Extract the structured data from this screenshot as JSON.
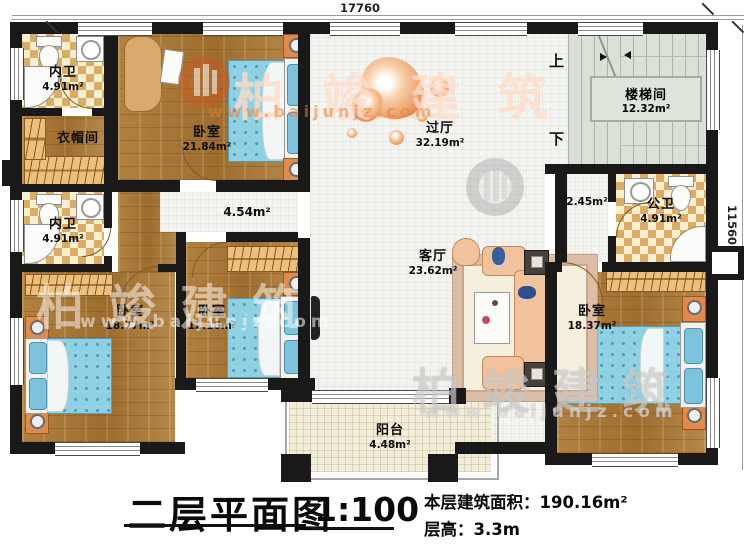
{
  "title_block": {
    "title": "二层平面图",
    "scale": "1:100",
    "building_area": "本层建筑面积：190.16m²",
    "floor_height": "层高：3.3m"
  },
  "dimensions": {
    "top": "17760",
    "right": "11560"
  },
  "stairs": {
    "name": "楼梯间",
    "area": "12.32m²",
    "up": "上",
    "down": "下"
  },
  "rooms": {
    "bath_top_left": {
      "name": "内卫",
      "area": "4.91m²"
    },
    "cloakroom": {
      "name": "衣帽间"
    },
    "bedroom_top": {
      "name": "卧室",
      "area": "21.84m²"
    },
    "bath_mid_left": {
      "name": "内卫",
      "area": "4.91m²"
    },
    "corridor": {
      "area": "4.54m²"
    },
    "hall": {
      "name": "过厅",
      "area": "32.19m²"
    },
    "corridor_small": {
      "area": "2.45m²"
    },
    "bath_public": {
      "name": "公卫",
      "area": "4.91m²"
    },
    "living": {
      "name": "客厅",
      "area": "23.62m²"
    },
    "bedroom_left": {
      "name": "卧室",
      "area": "18.77m²"
    },
    "bedroom_mid": {
      "name": "卧室",
      "area": "12.16m²"
    },
    "bedroom_right": {
      "name": "卧室",
      "area": "18.37m²"
    },
    "balcony": {
      "name": "阳台",
      "area": "4.48m²"
    }
  },
  "watermark": {
    "brand": "柏竣建筑",
    "url": "www.baijunjz.com"
  },
  "colors": {
    "wall": "#191919",
    "wood_floor": "#aa7a38",
    "bath_floor": "#e8c27c",
    "stair_floor": "#dbe1d7",
    "balcony_floor": "#f1edd8",
    "bed": "#8fd0e2",
    "sofa": "#f0c29e",
    "accent_orange": "#e08a4e"
  }
}
